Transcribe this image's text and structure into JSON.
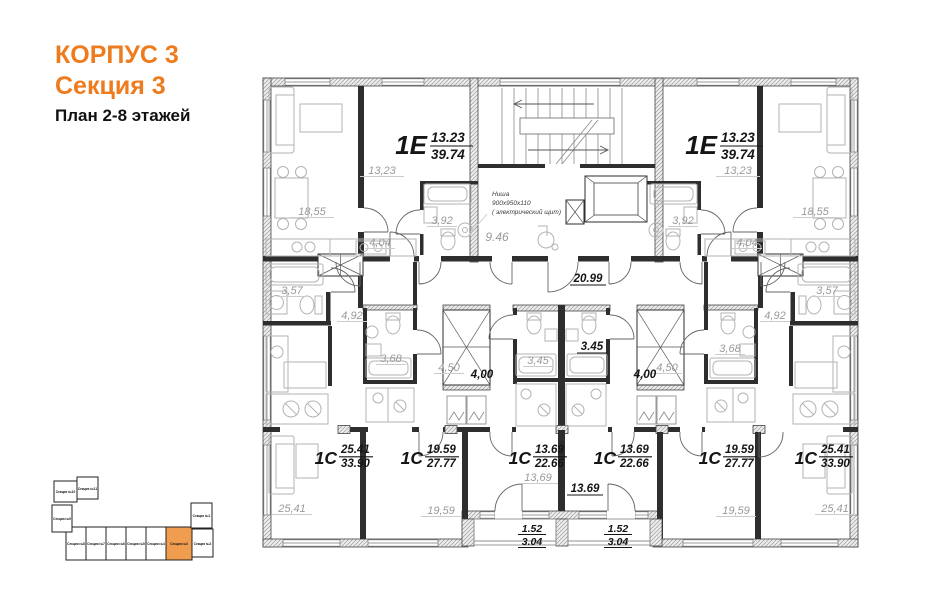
{
  "header": {
    "building": "КОРПУС 3",
    "section": "Секция 3",
    "floors": "План 2-8 этажей"
  },
  "colors": {
    "accent": "#EE7C1E",
    "minimap_highlight": "#F09D4F"
  },
  "apartments": [
    {
      "id": "top-left",
      "type": "1Е",
      "area_living": "13.23",
      "area_total": "39.74"
    },
    {
      "id": "top-right",
      "type": "1Е",
      "area_living": "13.23",
      "area_total": "39.74"
    },
    {
      "id": "bottom-1",
      "type": "1С",
      "area_living": "25.41",
      "area_total": "33.90"
    },
    {
      "id": "bottom-2",
      "type": "1С",
      "area_living": "19.59",
      "area_total": "27.77"
    },
    {
      "id": "bottom-3",
      "type": "1С",
      "area_living": "13.69",
      "area_total": "22.66"
    },
    {
      "id": "bottom-4",
      "type": "1С",
      "area_living": "13.69",
      "area_total": "22.66"
    },
    {
      "id": "bottom-5",
      "type": "1С",
      "area_living": "19.59",
      "area_total": "27.77"
    },
    {
      "id": "bottom-6",
      "type": "1С",
      "area_living": "25.41",
      "area_total": "33.90"
    }
  ],
  "labels": {
    "corridor": "20.99",
    "lobby": "9.46",
    "niche1": "Ниша",
    "niche2": "900х950х110",
    "niche3": "( электрический щит)",
    "tl": {
      "living": "18,55",
      "room": "13,23",
      "bath": "3,92",
      "hall": "4,04"
    },
    "tr": {
      "living": "18,55",
      "room": "13,23",
      "bath": "3,92",
      "hall": "4,04"
    },
    "ml": {
      "bath357": "3,57",
      "hall492": "4,92",
      "bath368": "3,68",
      "hall450": "4,50",
      "hall400": "4,00"
    },
    "mc": {
      "bath_left": "3,45",
      "bath_right": "3.45"
    },
    "mr": {
      "bath357": "3,57",
      "hall492": "4,92",
      "bath368": "3,68",
      "hall450": "4,50",
      "hall400": "4,00"
    },
    "rooms_bottom": [
      "25,41",
      "19,59",
      "13,69",
      "13.69",
      "19,59",
      "25,41"
    ],
    "balcony": {
      "num": "1.52",
      "den": "3.04"
    }
  },
  "minimap": {
    "highlighted": "Секция №3",
    "sections": [
      {
        "label": "Секция №1"
      },
      {
        "label": "Секция №2"
      },
      {
        "label": "Секция №3"
      },
      {
        "label": "Секция №4"
      },
      {
        "label": "Секция №5"
      },
      {
        "label": "Секция №6"
      },
      {
        "label": "Секция №7"
      },
      {
        "label": "Секция №8"
      },
      {
        "label": "Секция №9"
      },
      {
        "label": "Секция №10"
      },
      {
        "label": "Секция №11"
      }
    ]
  }
}
